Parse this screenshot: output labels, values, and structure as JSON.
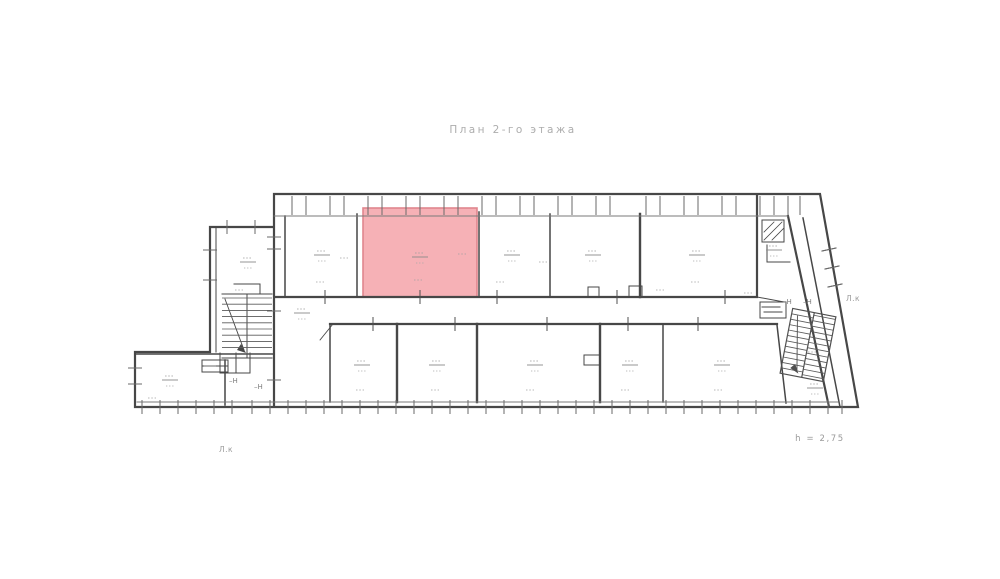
{
  "title": "План 2-го этажа",
  "footer_note": "h = 2,75",
  "stair_labels": {
    "left": "Л.к",
    "right": "Л.к"
  },
  "highlighted_room": {
    "fill": "#f5a9ae",
    "stroke": "#e0868e",
    "x": 363,
    "y": 208,
    "w": 114,
    "h": 89
  },
  "colors": {
    "wall": "#474747",
    "wall_light": "#6a6a6a",
    "inner_line": "#7a7a7a",
    "faint_text": "#9a9a9a",
    "title_text": "#adadad",
    "background": "#ffffff"
  },
  "plan": {
    "windows_top": [
      292,
      306,
      330,
      344,
      368,
      382,
      406,
      420,
      444,
      458,
      482,
      496,
      520,
      534,
      558,
      572,
      596,
      610,
      646,
      660,
      684,
      698,
      722,
      736,
      760,
      774,
      788,
      800
    ],
    "windows_bottom": [
      142,
      160,
      178,
      196,
      214,
      232,
      252,
      270,
      288,
      306,
      324,
      342,
      360,
      378,
      396,
      414,
      432,
      450,
      468,
      486,
      504,
      522,
      540,
      558,
      576,
      594,
      612,
      630,
      648,
      666,
      684,
      702,
      720,
      738,
      756,
      774,
      792,
      810,
      828,
      842
    ],
    "side_ticks": [
      [
        203,
        250,
        217,
        250
      ],
      [
        203,
        280,
        217,
        280
      ],
      [
        227,
        220,
        227,
        234
      ],
      [
        255,
        220,
        255,
        234
      ],
      [
        128,
        368,
        142,
        368
      ],
      [
        128,
        384,
        142,
        384
      ],
      [
        267,
        237,
        281,
        237
      ],
      [
        267,
        249,
        281,
        249
      ],
      [
        267,
        311,
        281,
        311
      ],
      [
        267,
        380,
        281,
        380
      ],
      [
        822,
        251,
        836,
        248
      ],
      [
        825,
        269,
        839,
        266
      ],
      [
        828,
        287,
        842,
        284
      ],
      [
        204,
        366,
        216,
        366
      ]
    ],
    "door_ticks": [
      [
        325,
        297
      ],
      [
        420,
        297
      ],
      [
        497,
        297
      ],
      [
        617,
        297
      ],
      [
        725,
        297
      ],
      [
        373,
        324
      ],
      [
        455,
        324
      ],
      [
        547,
        324
      ],
      [
        628,
        324
      ],
      [
        698,
        324
      ]
    ],
    "room_labels": [
      [
        322,
        255,
        0
      ],
      [
        420,
        257,
        0
      ],
      [
        512,
        255,
        0
      ],
      [
        593,
        255,
        0
      ],
      [
        697,
        255,
        0
      ],
      [
        362,
        365,
        0
      ],
      [
        437,
        365,
        0
      ],
      [
        535,
        365,
        0
      ],
      [
        630,
        365,
        0
      ],
      [
        722,
        365,
        0
      ],
      [
        170,
        380,
        0
      ],
      [
        248,
        262,
        0
      ],
      [
        815,
        388,
        0
      ],
      [
        302,
        313,
        0
      ],
      [
        774,
        250,
        0
      ],
      [
        320,
        282,
        1
      ],
      [
        418,
        280,
        1
      ],
      [
        462,
        254,
        1
      ],
      [
        344,
        258,
        1
      ],
      [
        543,
        262,
        1
      ],
      [
        500,
        282,
        1
      ],
      [
        695,
        282,
        1
      ],
      [
        660,
        290,
        1
      ],
      [
        360,
        390,
        1
      ],
      [
        435,
        390,
        1
      ],
      [
        530,
        390,
        1
      ],
      [
        625,
        390,
        1
      ],
      [
        718,
        390,
        1
      ],
      [
        152,
        398,
        1
      ],
      [
        812,
        352,
        1
      ],
      [
        748,
        293,
        1
      ],
      [
        239,
        290,
        1
      ]
    ],
    "texts": [
      {
        "t": "–Н",
        "x": 229,
        "y": 383,
        "n": "section-mark-1"
      },
      {
        "t": "–Н",
        "x": 254,
        "y": 389,
        "n": "section-mark-2"
      },
      {
        "t": "–Н",
        "x": 783,
        "y": 304,
        "n": "section-mark-3"
      },
      {
        "t": "–Н",
        "x": 803,
        "y": 304,
        "n": "section-mark-4"
      }
    ]
  }
}
